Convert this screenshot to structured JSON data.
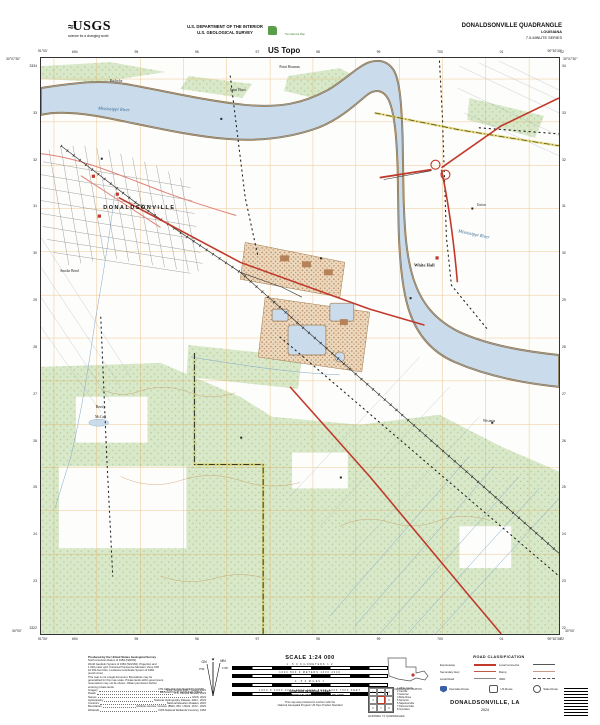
{
  "header": {
    "usgs_logo": {
      "wave": "≈",
      "word": "USGS",
      "tagline": "science for a changing world"
    },
    "dept_line1": "U.S. DEPARTMENT OF THE INTERIOR",
    "dept_line2": "U.S. GEOLOGICAL SURVEY",
    "ustopo": {
      "national_map": "The National Map",
      "brand": "US Topo"
    },
    "quad_title": "DONALDSONVILLE QUADRANGLE",
    "state": "LOUISIANA",
    "series": "7.5-MINUTE SERIES"
  },
  "map": {
    "corner_coords": {
      "top_left_lon": "91°00'",
      "top_left_lat": "30°07'30\"",
      "top_right_lon": "90°52'30\"",
      "top_right_lat": "30°07'30\"",
      "bottom_left_lon": "91°00'",
      "bottom_left_lat": "30°00'",
      "bottom_right_lon": "90°52'30\"",
      "bottom_right_lat": "30°00'"
    },
    "grid_ticks": {
      "top": [
        "694",
        "95",
        "96",
        "97",
        "98",
        "99",
        "700",
        "01",
        "02"
      ],
      "bottom": [
        "694",
        "95",
        "96",
        "97",
        "98",
        "99",
        "700",
        "01",
        "02"
      ],
      "left": [
        "3334",
        "33",
        "32",
        "31",
        "30",
        "29",
        "28",
        "27",
        "26",
        "25",
        "24",
        "23",
        "3322"
      ],
      "right": [
        "34",
        "33",
        "32",
        "31",
        "30",
        "29",
        "28",
        "27",
        "26",
        "25",
        "24",
        "23",
        "22"
      ]
    },
    "labels": [
      {
        "t": "Point Houmas",
        "x": 48,
        "y": 1.6,
        "c": "small",
        "r": 0
      },
      {
        "t": "Bachelor",
        "x": 14.5,
        "y": 4.0,
        "c": "small",
        "r": 0
      },
      {
        "t": "Saint Elmo",
        "x": 38,
        "y": 5.6,
        "c": "small",
        "r": 0
      },
      {
        "t": "Mississippi River",
        "x": 14,
        "y": 8.8,
        "c": "water",
        "r": 3
      },
      {
        "t": "Mississippi River",
        "x": 83.5,
        "y": 30.5,
        "c": "water",
        "r": 12
      },
      {
        "t": "DONALDSONVILLE",
        "x": 19,
        "y": 26,
        "c": "town",
        "r": 0
      },
      {
        "t": "Smoke Bend",
        "x": 5.5,
        "y": 37,
        "c": "small",
        "r": 0
      },
      {
        "t": "White Hall",
        "x": 74,
        "y": 36,
        "c": "place",
        "r": 0
      },
      {
        "t": "Union",
        "x": 85,
        "y": 25.5,
        "c": "small",
        "r": 0
      },
      {
        "t": "Wisteria",
        "x": 86.5,
        "y": 63,
        "c": "small",
        "r": 0
      },
      {
        "t": "Brusly",
        "x": 11.5,
        "y": 60.6,
        "c": "small",
        "r": 0
      },
      {
        "t": "McCall",
        "x": 11.5,
        "y": 62.3,
        "c": "small",
        "r": 0
      }
    ],
    "colors": {
      "water": "#cadcec",
      "vegetation": "#d8e8c8",
      "road_red": "#c0392b",
      "grid_orange": "#e09a3c",
      "levee_tan": "#9a7442",
      "boundary_yellow": "#d8c840"
    }
  },
  "footer": {
    "credits": {
      "lines": [
        "Produced by the United States Geological Survey",
        "North American Datum of 1983 (NAD83)",
        "World Geodetic System of 1984 (WGS84). Projection and",
        "1 000-meter grid: Universal Transverse Mercator, Zone 15R",
        "10 000-foot ticks: Louisiana Coordinate System of 1983",
        "(south zone)",
        "This map is not a legal document. Boundaries may be",
        "generalized for this map scale. Private lands within government",
        "reservations may not be shown. Obtain permission before",
        "entering private lands."
      ],
      "sources": [
        {
          "label": "Imagery",
          "value": "NAIP, August 2021 - August 2022"
        },
        {
          "label": "Roads",
          "value": "U.S. Census Bureau, 2023"
        },
        {
          "label": "Names",
          "value": "GNIS, 2024"
        },
        {
          "label": "Hydrography",
          "value": "National Hydrography Dataset, 2004 - 2023"
        },
        {
          "label": "Contours",
          "value": "National Elevation Dataset, 2015"
        },
        {
          "label": "Boundaries",
          "value": "Multiple sources; Census, IBWC, IBC, USGS, 1972 - 2023"
        },
        {
          "label": "Wetlands",
          "value": "FWS National Wetlands Inventory, 1984"
        }
      ]
    },
    "declination": {
      "gn": "GN",
      "mn": "MN",
      "gn_angle": "0°31'",
      "mn_angle": "1°29'",
      "caption1": "UTM GRID AND 2024 MAGNETIC NORTH",
      "caption2": "DECLINATION AT CENTER OF SHEET"
    },
    "scale": {
      "title": "SCALE 1:24 000",
      "bars": [
        {
          "ticks": "1   .5   0   KILOMETERS   1   2"
        },
        {
          "ticks": "1000   500   0   METERS   1000   2000"
        },
        {
          "ticks": "1   .5   0   MILES   1"
        },
        {
          "ticks": "1000   0   1000  2000  3000  4000  5000  6000  7000   FEET"
        }
      ],
      "contour1": "CONTOUR INTERVAL 5 FEET",
      "contour2": "NORTH AMERICAN VERTICAL DATUM OF 1988",
      "conform1": "This map was produced to conform with the",
      "conform2": "National Geospatial Program US Topo Product Standard"
    },
    "location": {
      "caption": "QUADRANGLE LOCATION"
    },
    "adjoining": {
      "caption": "ADJOINING 7.5' QUADRANGLES",
      "names": [
        "White Castle",
        "Carville",
        "Geismar",
        "Belle Rose",
        "Sorrento",
        "Napoleonville",
        "Paincourtville",
        "Gonzales"
      ]
    },
    "road_class": {
      "title": "ROAD CLASSIFICATION",
      "columns": [
        [
          {
            "label": "Expressway",
            "style": "expressway"
          },
          {
            "label": "Secondary Hwy",
            "style": "secondary"
          },
          {
            "label": "Local Road",
            "style": "local"
          }
        ],
        [
          {
            "label": "Local Connector",
            "style": "connector"
          },
          {
            "label": "Ramp",
            "style": "ramp"
          },
          {
            "label": "4WD",
            "style": "fourwd"
          }
        ]
      ],
      "shields": [
        {
          "shield": "interstate",
          "label": "Interstate Route"
        },
        {
          "shield": "us",
          "label": "US Route"
        },
        {
          "shield": "state",
          "label": "State Route"
        }
      ]
    },
    "sheet_name": "DONALDSONVILLE,  LA",
    "year": "2024"
  }
}
